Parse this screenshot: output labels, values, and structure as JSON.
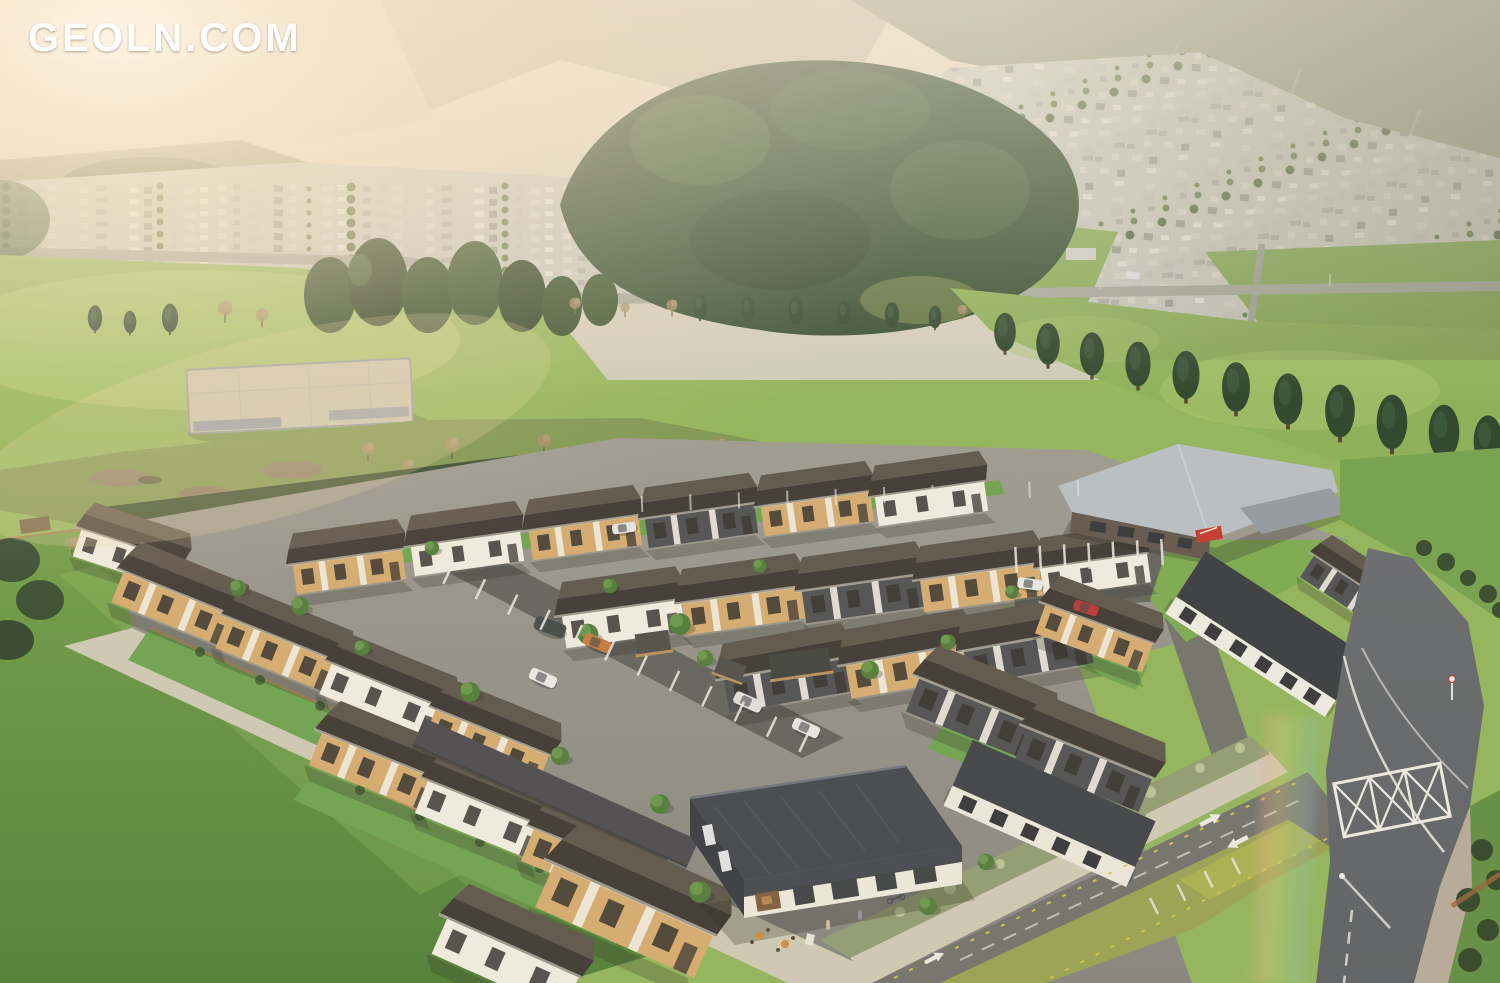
{
  "watermark": {
    "text": "GEOLN.COM"
  },
  "palette": {
    "haze": "#ecdfc9",
    "mountain": "#99a089",
    "forest": "#2d462a",
    "field_green": "#8eb457",
    "lawn_green": "#5f9140",
    "hedge_dark": "#30462a",
    "roof_charcoal": "#3a352f",
    "roof_light_slope": "#5a5248",
    "timber_tan": "#d3aa6d",
    "facade_white": "#efece0",
    "cladding_dark": "#484a4e",
    "asphalt_light": "#94928a",
    "asphalt_dark": "#5e5f5b",
    "road_grey": "#63666b",
    "marking_white": "#eceae2",
    "marking_yellow": "#d9c53e",
    "sign_red": "#c2342a",
    "community_roof": "#b6bdc4",
    "path_gravel": "#cdc7b4"
  }
}
